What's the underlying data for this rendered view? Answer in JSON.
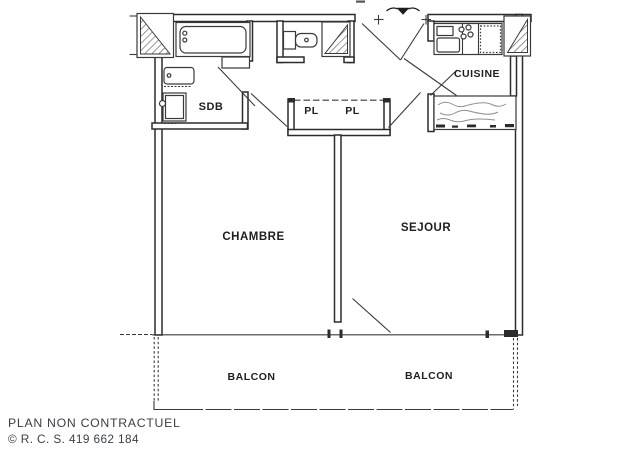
{
  "colors": {
    "ink": "#2c2c2c",
    "label_text": "#1f1f1f",
    "footer_text": "#3b4049",
    "hatch": "#6a6a6a",
    "background": "#ffffff"
  },
  "labels": {
    "sdb": "SDB",
    "pl_left": "PL",
    "pl_right": "PL",
    "cuisine": "CUISINE",
    "chambre": "CHAMBRE",
    "sejour": "SEJOUR",
    "balcon_left": "BALCON",
    "balcon_right": "BALCON"
  },
  "footer": {
    "disclaimer": "PLAN NON CONTRACTUEL",
    "registration": "© R. C. S. 419 662 184"
  }
}
